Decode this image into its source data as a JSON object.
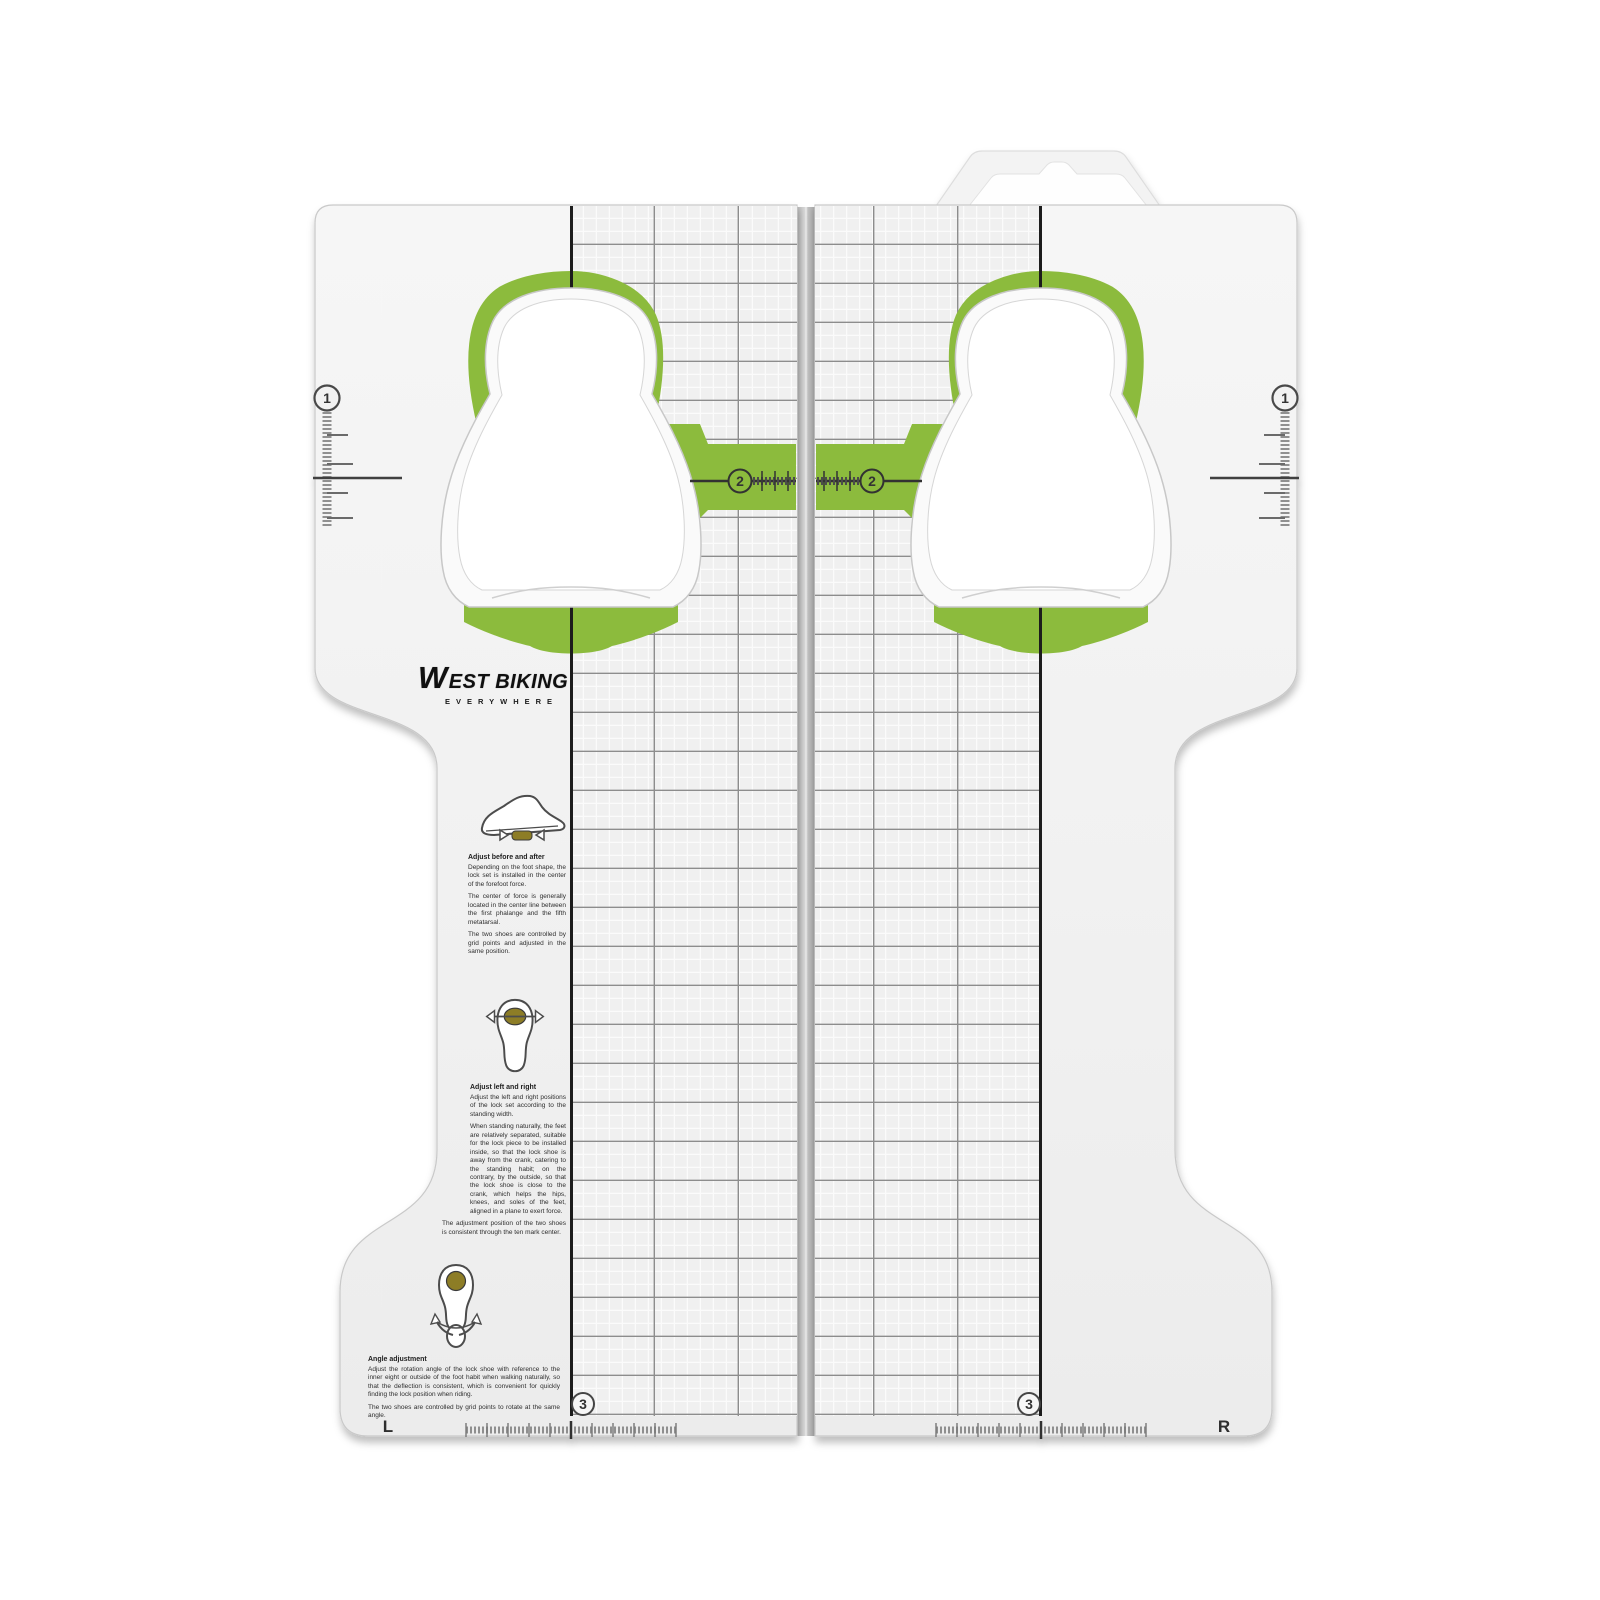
{
  "logo": {
    "w": "W",
    "rest": "EST BIKING",
    "tagline": "EVERYWHERE"
  },
  "markers": {
    "one": "1",
    "two": "2",
    "three": "3",
    "left": "L",
    "right": "R"
  },
  "colors": {
    "green": "#8cbb3e",
    "cleat_olive": "#8d7d26",
    "panel": "#f2f2f2",
    "grid_fine": "#fbfbfb",
    "grid_bold": "#8d8d8d",
    "dark_line": "#1f1f1f"
  },
  "instructions": [
    {
      "icon": "shoe-side-view-icon",
      "heading": "Adjust before and after",
      "paragraphs": [
        "Depending on the foot shape, the lock set is installed in the center of the forefoot force.",
        "The center of force is generally located in the center line between the first phalange and the fifth metatarsal.",
        "The two shoes are controlled by grid points and adjusted in the same position."
      ]
    },
    {
      "icon": "sole-width-adjust-icon",
      "heading": "Adjust left and right",
      "paragraphs": [
        "Adjust the left and right positions of the lock set according to the standing width.",
        "When standing naturally, the feet are relatively separated, suitable for the lock piece to be installed inside, so that the lock shoe is away from the crank, catering to the standing habit; on the contrary, by the outside, so that the lock shoe is close to the crank, which helps the hips, knees, and soles of the feet, aligned in a plane to exert force.",
        "The adjustment position of the two shoes is consistent through the ten mark center."
      ]
    },
    {
      "icon": "sole-angle-adjust-icon",
      "heading": "Angle adjustment",
      "paragraphs": [
        "Adjust the rotation angle of the lock shoe with reference to the inner eight or outside of the foot habit when walking naturally, so that the deflection is consistent, which is convenient for quickly finding the lock position when riding.",
        "The two shoes are controlled by grid points to rotate at the same angle."
      ]
    }
  ]
}
